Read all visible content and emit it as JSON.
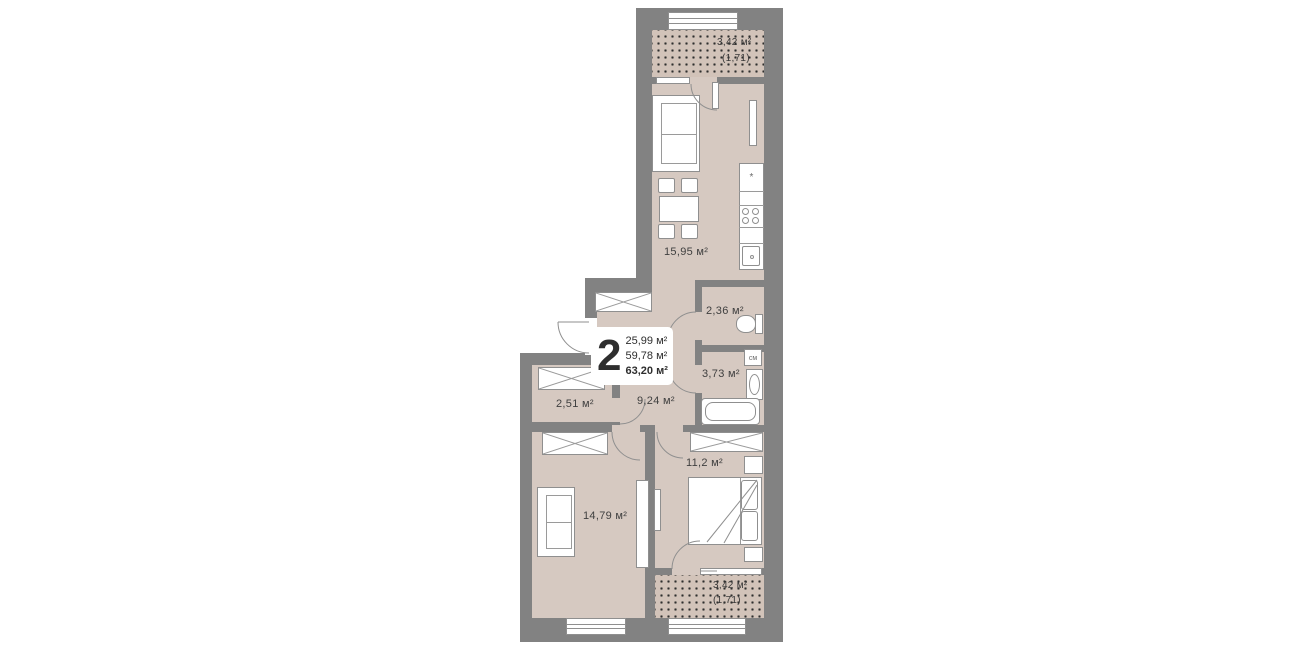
{
  "info_box": {
    "room_count": "2",
    "areas": [
      "25,99 м²",
      "59,78 м²",
      "63,20 м²"
    ]
  },
  "rooms": {
    "kitchen_living": "15,95 м²",
    "wc": "2,36 м²",
    "bathroom": "3,73 м²",
    "wardrobe": "2,51 м²",
    "hallway": "9,24 м²",
    "bedroom": "11,2 м²",
    "living_room": "14,79 м²"
  },
  "balconies": {
    "top": {
      "area": "3,42 м²",
      "reduced": "(1,71)"
    },
    "bottom": {
      "area": "3,42 м²",
      "reduced": "(1,71)"
    }
  },
  "appliances": {
    "washing_machine": "см",
    "fridge_symbol": "*"
  },
  "colors": {
    "background": "#ffffff",
    "wall": "#828282",
    "floor": "#d6c9c1",
    "balcony_floor": "#d2c3b9",
    "furniture_outline": "#8f8f8f",
    "text": "#3f3f3f"
  }
}
